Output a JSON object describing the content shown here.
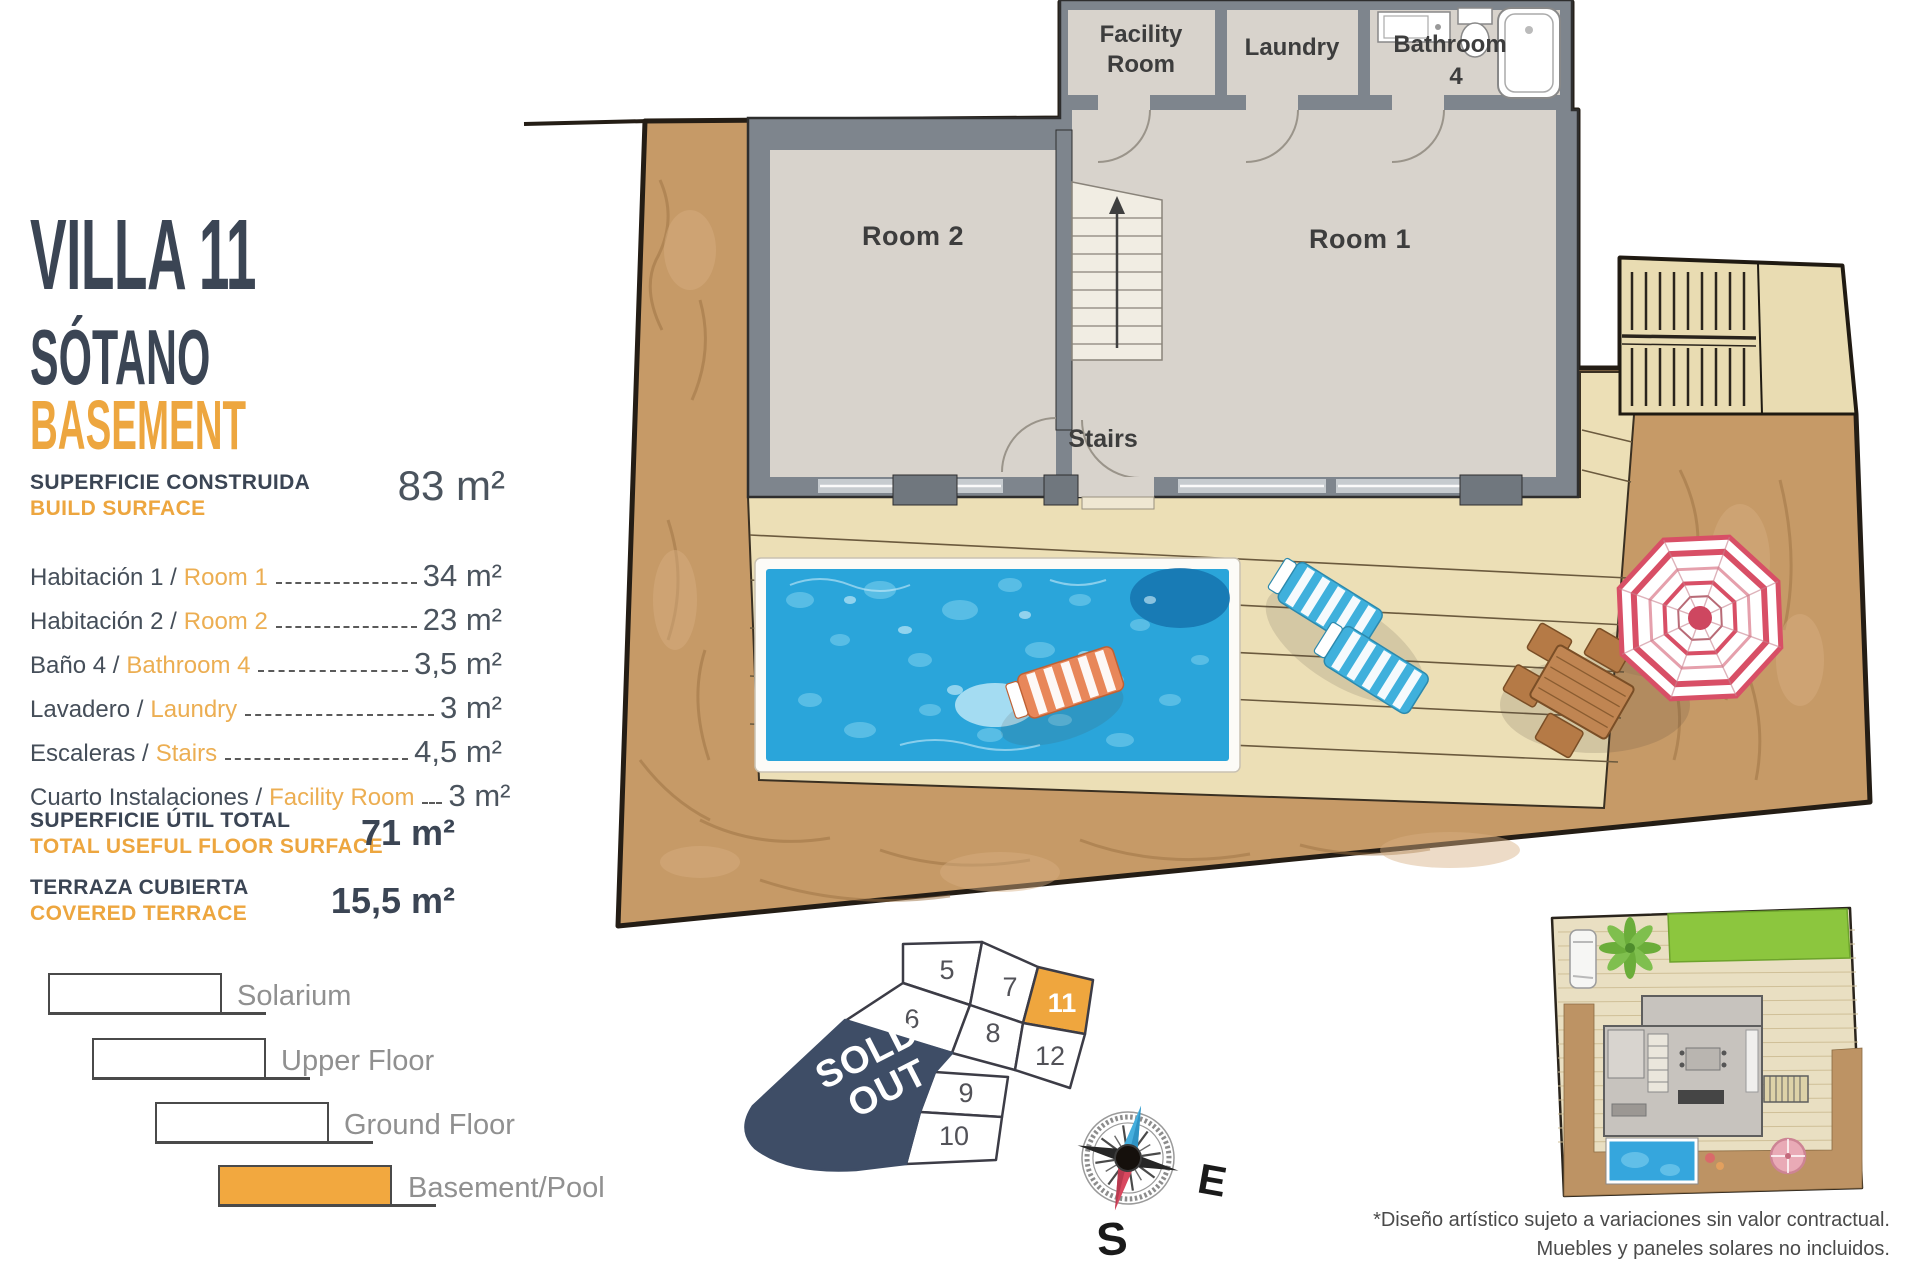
{
  "title": {
    "villa": "VILLA 11",
    "floor_es": "SÓTANO",
    "floor_en": "BASEMENT"
  },
  "build_surface": {
    "label_es": "SUPERFICIE CONSTRUIDA",
    "label_en": "BUILD SURFACE",
    "value": "83 m²"
  },
  "surface_rows": [
    {
      "es": "Habitación 1 /",
      "en": "Room 1",
      "value": "34 m²"
    },
    {
      "es": "Habitación 2 /",
      "en": "Room 2",
      "value": "23 m²"
    },
    {
      "es": "Baño 4 /",
      "en": "Bathroom 4",
      "value": "3,5 m²"
    },
    {
      "es": "Lavadero /",
      "en": "Laundry",
      "value": "3 m²"
    },
    {
      "es": "Escaleras /",
      "en": "Stairs",
      "value": "4,5 m²"
    },
    {
      "es": "Cuarto Instalaciones /",
      "en": "Facility Room",
      "value": "3 m²"
    }
  ],
  "totals": [
    {
      "label_es": "SUPERFICIE ÚTIL TOTAL",
      "label_en": "TOTAL USEFUL FLOOR SURFACE",
      "value": "71 m²"
    },
    {
      "label_es": "TERRAZA CUBIERTA",
      "label_en": "COVERED TERRACE",
      "value": "15,5 m²"
    }
  ],
  "floor_legend": [
    {
      "label": "Solarium"
    },
    {
      "label": "Upper Floor"
    },
    {
      "label": "Ground Floor"
    },
    {
      "label": "Basement/Pool",
      "highlight": true
    }
  ],
  "plan_labels": {
    "room2": "Room 2",
    "room1": "Room 1",
    "stairs": "Stairs",
    "facility_l1": "Facility",
    "facility_l2": "Room",
    "laundry": "Laundry",
    "bathroom_l1": "Bathroom",
    "bathroom_l2": "4"
  },
  "key_map": {
    "sold_l1": "SOLD",
    "sold_l2": "OUT",
    "plots": [
      "5",
      "7",
      "11",
      "6",
      "8",
      "12",
      "9",
      "10"
    ],
    "highlighted_plot": "11"
  },
  "compass": {
    "east": "E",
    "south": "S"
  },
  "disclaimer": {
    "line1": "*Diseño artístico sujeto a variaciones sin valor contractual.",
    "line2": "Muebles y paneles solares no incluidos."
  },
  "colors": {
    "accent_orange": "#eda63f",
    "dark_navy": "#3b4554",
    "sold_out_navy": "#3e4d66",
    "earth_brown": "#c69a67",
    "deck_beige": "#ecdfb6",
    "pool_blue": "#2aa5da",
    "lawn_green": "#8cc63e"
  }
}
